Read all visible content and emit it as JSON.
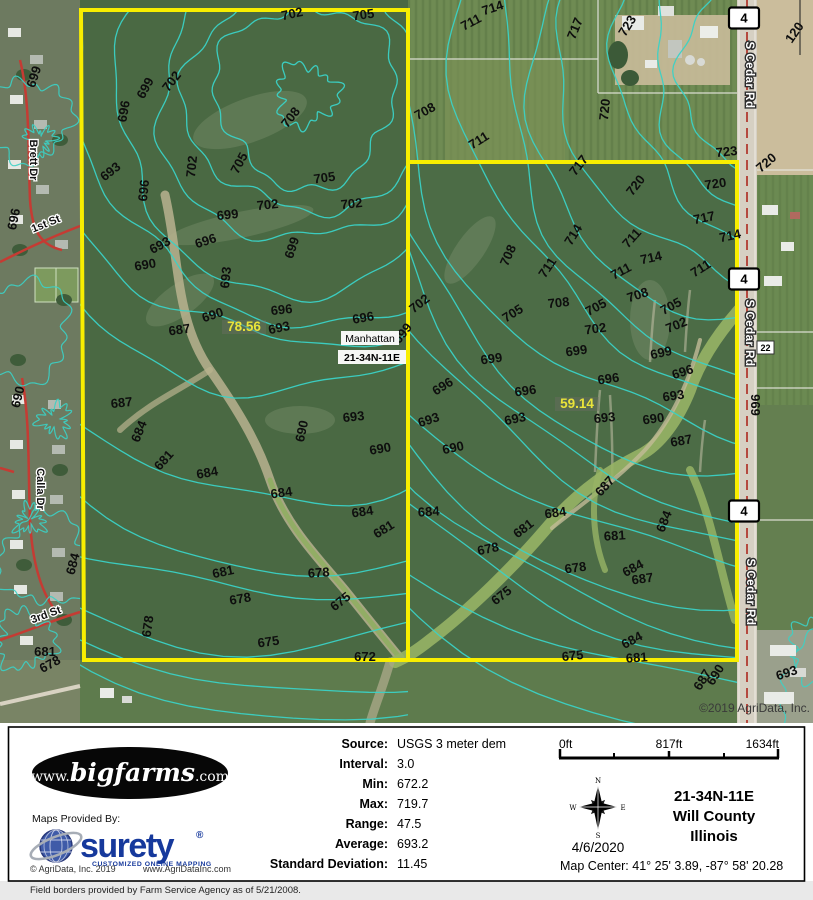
{
  "map": {
    "attribution": "©2019 AgriData, Inc.",
    "parcel_labels": {
      "place": "Manhattan",
      "township": "21-34N-11E"
    },
    "highlights": [
      {
        "text": "78.56",
        "x": 244,
        "y": 331
      },
      {
        "text": "59.14",
        "x": 577,
        "y": 408
      }
    ],
    "roads": {
      "name_labels": [
        {
          "text": "S Cedar Rd",
          "x": 746,
          "y": 75
        },
        {
          "text": "S Cedar Rd",
          "x": 746,
          "y": 333
        },
        {
          "text": "S Cedar Rd",
          "x": 747,
          "y": 592
        }
      ],
      "route_shields": [
        {
          "text": "4",
          "x": 744,
          "y": 18
        },
        {
          "text": "4",
          "x": 744,
          "y": 279
        },
        {
          "text": "4",
          "x": 744,
          "y": 511
        }
      ],
      "mile_marker": {
        "text": "22"
      }
    },
    "street_labels": [
      {
        "text": "Brett Dr",
        "x": 30,
        "y": 160,
        "r": 90
      },
      {
        "text": "1st St",
        "x": 47,
        "y": 227,
        "r": -22
      },
      {
        "text": "Calla Dr",
        "x": 37,
        "y": 489,
        "r": 90
      },
      {
        "text": "3rd St",
        "x": 47,
        "y": 618,
        "r": -20
      }
    ],
    "misc_labels": [
      {
        "t": "969",
        "x": 751,
        "y": 405,
        "r": 90
      },
      {
        "t": "120",
        "x": 798,
        "y": 35,
        "r": -55
      }
    ],
    "contour_labels": [
      {
        "t": "699",
        "x": 38,
        "y": 78,
        "r": -72
      },
      {
        "t": "696",
        "x": 18,
        "y": 220,
        "r": -78
      },
      {
        "t": "690",
        "x": 22,
        "y": 398,
        "r": -76
      },
      {
        "t": "684",
        "x": 77,
        "y": 565,
        "r": -75
      },
      {
        "t": "681",
        "x": 45,
        "y": 656,
        "r": 0
      },
      {
        "t": "678",
        "x": 52,
        "y": 668,
        "r": -28
      },
      {
        "t": "702",
        "x": 293,
        "y": 18,
        "r": -12
      },
      {
        "t": "705",
        "x": 364,
        "y": 19,
        "r": -8
      },
      {
        "t": "699",
        "x": 149,
        "y": 90,
        "r": -62
      },
      {
        "t": "702",
        "x": 175,
        "y": 84,
        "r": -52
      },
      {
        "t": "696",
        "x": 128,
        "y": 112,
        "r": -80
      },
      {
        "t": "708",
        "x": 294,
        "y": 120,
        "r": -52
      },
      {
        "t": "693",
        "x": 113,
        "y": 175,
        "r": -38
      },
      {
        "t": "702",
        "x": 196,
        "y": 167,
        "r": -84
      },
      {
        "t": "705",
        "x": 243,
        "y": 165,
        "r": -62
      },
      {
        "t": "705",
        "x": 325,
        "y": 182,
        "r": -8
      },
      {
        "t": "696",
        "x": 148,
        "y": 191,
        "r": -84
      },
      {
        "t": "699",
        "x": 228,
        "y": 219,
        "r": -6
      },
      {
        "t": "702",
        "x": 268,
        "y": 209,
        "r": -6
      },
      {
        "t": "702",
        "x": 352,
        "y": 208,
        "r": -6
      },
      {
        "t": "693",
        "x": 162,
        "y": 249,
        "r": -28
      },
      {
        "t": "696",
        "x": 207,
        "y": 245,
        "r": -18
      },
      {
        "t": "699",
        "x": 296,
        "y": 249,
        "r": -72
      },
      {
        "t": "690",
        "x": 146,
        "y": 269,
        "r": -10
      },
      {
        "t": "693",
        "x": 230,
        "y": 278,
        "r": -84
      },
      {
        "t": "690",
        "x": 214,
        "y": 319,
        "r": -18
      },
      {
        "t": "696",
        "x": 282,
        "y": 314,
        "r": -6
      },
      {
        "t": "687",
        "x": 180,
        "y": 334,
        "r": -8
      },
      {
        "t": "693",
        "x": 280,
        "y": 332,
        "r": -12
      },
      {
        "t": "696",
        "x": 364,
        "y": 322,
        "r": -10
      },
      {
        "t": "699",
        "x": 406,
        "y": 336,
        "r": -52
      },
      {
        "t": "687",
        "x": 122,
        "y": 407,
        "r": -6
      },
      {
        "t": "684",
        "x": 143,
        "y": 433,
        "r": -68
      },
      {
        "t": "693",
        "x": 354,
        "y": 421,
        "r": -6
      },
      {
        "t": "690",
        "x": 306,
        "y": 432,
        "r": -78
      },
      {
        "t": "690",
        "x": 381,
        "y": 453,
        "r": -10
      },
      {
        "t": "681",
        "x": 167,
        "y": 463,
        "r": -48
      },
      {
        "t": "684",
        "x": 208,
        "y": 477,
        "r": -10
      },
      {
        "t": "684",
        "x": 282,
        "y": 497,
        "r": -8
      },
      {
        "t": "684",
        "x": 363,
        "y": 516,
        "r": -8
      },
      {
        "t": "681",
        "x": 386,
        "y": 533,
        "r": -32
      },
      {
        "t": "681",
        "x": 224,
        "y": 576,
        "r": -12
      },
      {
        "t": "678",
        "x": 319,
        "y": 577,
        "r": -4
      },
      {
        "t": "678",
        "x": 241,
        "y": 603,
        "r": -10
      },
      {
        "t": "675",
        "x": 343,
        "y": 605,
        "r": -38
      },
      {
        "t": "678",
        "x": 152,
        "y": 627,
        "r": -82
      },
      {
        "t": "675",
        "x": 269,
        "y": 646,
        "r": -8
      },
      {
        "t": "672",
        "x": 365,
        "y": 661,
        "r": 0
      },
      {
        "t": "714",
        "x": 494,
        "y": 12,
        "r": -18
      },
      {
        "t": "711",
        "x": 473,
        "y": 26,
        "r": -28
      },
      {
        "t": "717",
        "x": 579,
        "y": 30,
        "r": -68
      },
      {
        "t": "723",
        "x": 631,
        "y": 28,
        "r": -58
      },
      {
        "t": "720",
        "x": 609,
        "y": 110,
        "r": -84
      },
      {
        "t": "708",
        "x": 427,
        "y": 115,
        "r": -28
      },
      {
        "t": "711",
        "x": 481,
        "y": 144,
        "r": -32
      },
      {
        "t": "723",
        "x": 727,
        "y": 156,
        "r": -6
      },
      {
        "t": "720",
        "x": 769,
        "y": 166,
        "r": -40
      },
      {
        "t": "717",
        "x": 582,
        "y": 168,
        "r": -52
      },
      {
        "t": "720",
        "x": 639,
        "y": 188,
        "r": -52
      },
      {
        "t": "720",
        "x": 716,
        "y": 188,
        "r": -8
      },
      {
        "t": "717",
        "x": 705,
        "y": 222,
        "r": -12
      },
      {
        "t": "714",
        "x": 731,
        "y": 240,
        "r": -12
      },
      {
        "t": "714",
        "x": 577,
        "y": 237,
        "r": -58
      },
      {
        "t": "711",
        "x": 635,
        "y": 241,
        "r": -48
      },
      {
        "t": "708",
        "x": 512,
        "y": 257,
        "r": -66
      },
      {
        "t": "711",
        "x": 551,
        "y": 270,
        "r": -56
      },
      {
        "t": "714",
        "x": 652,
        "y": 262,
        "r": -12
      },
      {
        "t": "711",
        "x": 623,
        "y": 275,
        "r": -28
      },
      {
        "t": "711",
        "x": 703,
        "y": 272,
        "r": -32
      },
      {
        "t": "708",
        "x": 639,
        "y": 299,
        "r": -18
      },
      {
        "t": "702",
        "x": 422,
        "y": 307,
        "r": -38
      },
      {
        "t": "708",
        "x": 559,
        "y": 307,
        "r": -6
      },
      {
        "t": "705",
        "x": 515,
        "y": 317,
        "r": -32
      },
      {
        "t": "705",
        "x": 598,
        "y": 311,
        "r": -28
      },
      {
        "t": "705",
        "x": 673,
        "y": 310,
        "r": -28
      },
      {
        "t": "702",
        "x": 596,
        "y": 333,
        "r": -8
      },
      {
        "t": "702",
        "x": 678,
        "y": 329,
        "r": -22
      },
      {
        "t": "699",
        "x": 492,
        "y": 363,
        "r": -8
      },
      {
        "t": "699",
        "x": 577,
        "y": 355,
        "r": -8
      },
      {
        "t": "699",
        "x": 662,
        "y": 357,
        "r": -12
      },
      {
        "t": "696",
        "x": 445,
        "y": 390,
        "r": -32
      },
      {
        "t": "696",
        "x": 526,
        "y": 395,
        "r": -8
      },
      {
        "t": "696",
        "x": 609,
        "y": 383,
        "r": -8
      },
      {
        "t": "696",
        "x": 684,
        "y": 376,
        "r": -18
      },
      {
        "t": "693",
        "x": 674,
        "y": 400,
        "r": -8
      },
      {
        "t": "693",
        "x": 430,
        "y": 424,
        "r": -18
      },
      {
        "t": "693",
        "x": 516,
        "y": 423,
        "r": -12
      },
      {
        "t": "693",
        "x": 605,
        "y": 422,
        "r": -6
      },
      {
        "t": "690",
        "x": 654,
        "y": 423,
        "r": -8
      },
      {
        "t": "690",
        "x": 454,
        "y": 452,
        "r": -12
      },
      {
        "t": "687",
        "x": 682,
        "y": 445,
        "r": -10
      },
      {
        "t": "687",
        "x": 608,
        "y": 489,
        "r": -48
      },
      {
        "t": "684",
        "x": 429,
        "y": 516,
        "r": -4
      },
      {
        "t": "684",
        "x": 556,
        "y": 517,
        "r": -8
      },
      {
        "t": "681",
        "x": 526,
        "y": 532,
        "r": -38
      },
      {
        "t": "684",
        "x": 668,
        "y": 523,
        "r": -68
      },
      {
        "t": "681",
        "x": 615,
        "y": 540,
        "r": -4
      },
      {
        "t": "678",
        "x": 489,
        "y": 553,
        "r": -12
      },
      {
        "t": "678",
        "x": 576,
        "y": 572,
        "r": -8
      },
      {
        "t": "684",
        "x": 635,
        "y": 572,
        "r": -28
      },
      {
        "t": "687",
        "x": 643,
        "y": 583,
        "r": -8
      },
      {
        "t": "675",
        "x": 504,
        "y": 599,
        "r": -38
      },
      {
        "t": "684",
        "x": 634,
        "y": 644,
        "r": -28
      },
      {
        "t": "675",
        "x": 573,
        "y": 660,
        "r": -6
      },
      {
        "t": "681",
        "x": 637,
        "y": 662,
        "r": -4
      },
      {
        "t": "690",
        "x": 719,
        "y": 677,
        "r": -58
      },
      {
        "t": "687",
        "x": 706,
        "y": 682,
        "r": -58
      },
      {
        "t": "693",
        "x": 788,
        "y": 677,
        "r": -18
      }
    ]
  },
  "footer": {
    "stats": [
      {
        "label": "Source:",
        "value": "USGS 3 meter dem"
      },
      {
        "label": "Interval:",
        "value": "3.0"
      },
      {
        "label": "Min:",
        "value": "672.2"
      },
      {
        "label": "Max:",
        "value": "719.7"
      },
      {
        "label": "Range:",
        "value": "47.5"
      },
      {
        "label": "Average:",
        "value": "693.2"
      },
      {
        "label": "Standard Deviation:",
        "value": "11.45"
      }
    ],
    "scale": {
      "start": "0ft",
      "middle": "817ft",
      "end": "1634ft"
    },
    "compass": {
      "n": "N",
      "e": "E",
      "s": "S",
      "w": "W"
    },
    "date": "4/6/2020",
    "township": "21-34N-11E",
    "county": "Will County",
    "state": "Illinois",
    "map_center": "Map Center: 41° 25' 3.89,  -87° 58' 20.28",
    "branding": {
      "bigfarms_prefix": "www.",
      "bigfarms_name": "bigfarms",
      "bigfarms_suffix": ".com",
      "provided_by": "Maps Provided By:",
      "surety_name": "surety",
      "surety_reg": "®",
      "surety_tagline": "CUSTOMIZED ONLINE MAPPING",
      "agridata_copyright": "© AgriData, Inc. 2019",
      "agridata_url": "www.AgriDataInc.com"
    },
    "disclaimer": "Field borders provided by Farm Service Agency as of 5/21/2008."
  },
  "colors": {
    "boundary": "#f8ee00",
    "contour": "#3bd2c6",
    "highlight": "#e9e43a",
    "surety_blue": "#16399c"
  }
}
